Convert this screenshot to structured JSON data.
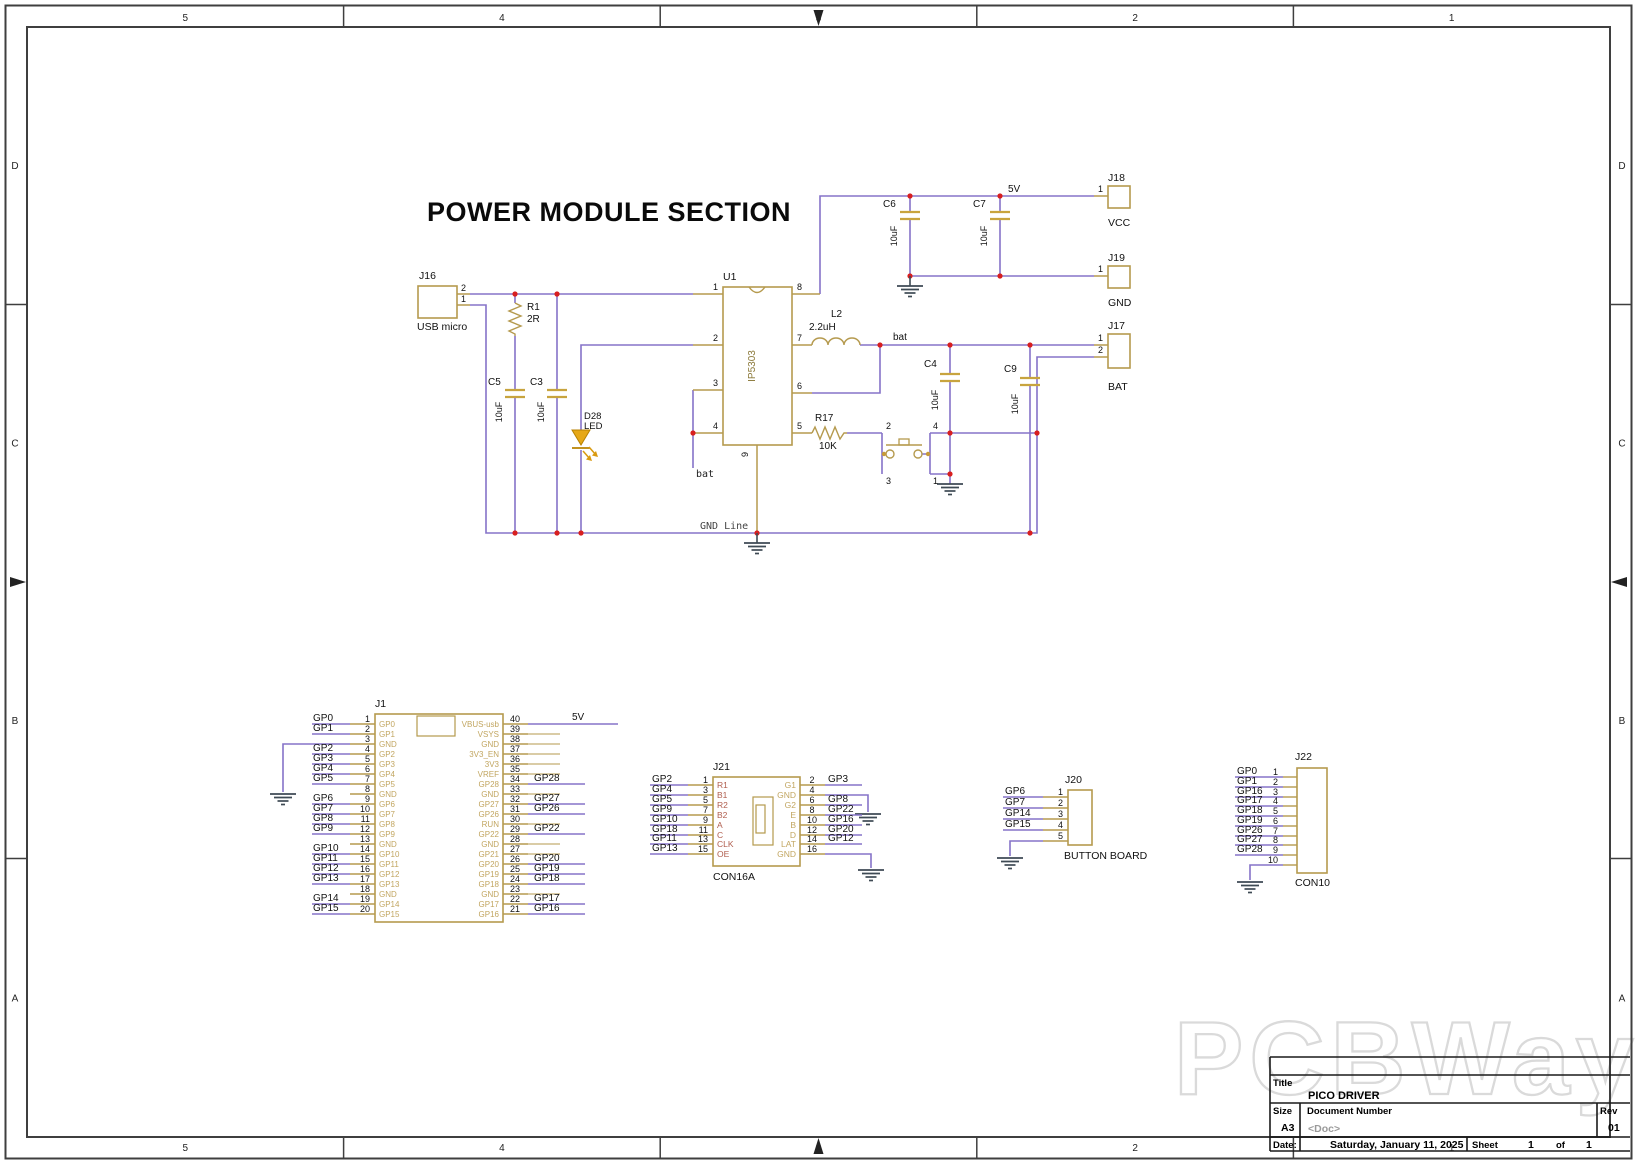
{
  "sheet": {
    "zones_top": [
      "5",
      "4",
      "3",
      "2",
      "1"
    ],
    "zones_side": [
      "D",
      "C",
      "B",
      "A"
    ],
    "watermark": "PCBWay"
  },
  "title_block": {
    "title_label": "Title",
    "title": "PICO DRIVER",
    "size_label": "Size",
    "size": "A3",
    "doc_label": "Document Number",
    "doc": "<Doc>",
    "rev_label": "Rev",
    "rev": "01",
    "date_label": "Date:",
    "date": "Saturday, January 11, 2025",
    "sheet_label": "Sheet",
    "sheet_num": "1",
    "of_label": "of",
    "sheet_total": "1"
  },
  "power": {
    "heading": "POWER MODULE SECTION",
    "j16_ref": "J16",
    "j16_name": "USB micro",
    "j16_p2": "2",
    "j16_p1": "1",
    "r1_ref": "R1",
    "r1_val": "2R",
    "c5_ref": "C5",
    "c5_val": "10uF",
    "c3_ref": "C3",
    "c3_val": "10uF",
    "d28_ref": "D28",
    "d28_val": "LED",
    "u1_ref": "U1",
    "u1_val": "IP5303",
    "u1_p1": "1",
    "u1_p2": "2",
    "u1_p3": "3",
    "u1_p4": "4",
    "u1_p5": "5",
    "u1_p6": "6",
    "u1_p7": "7",
    "u1_p8": "8",
    "u1_p9": "9",
    "l2_ref": "L2",
    "l2_val": "2.2uH",
    "c6_ref": "C6",
    "c6_val": "10uF",
    "c7_ref": "C7",
    "c7_val": "10uF",
    "c4_ref": "C4",
    "c4_val": "10uF",
    "c9_ref": "C9",
    "c9_val": "10uF",
    "r17_ref": "R17",
    "r17_val": "10K",
    "sw_p1": "1",
    "sw_p2": "2",
    "sw_p3": "3",
    "sw_p4": "4",
    "net_5v": "5V",
    "net_bat_rail": "bat",
    "net_bat_stub": "bat",
    "gnd_line": "GND Line",
    "j18_ref": "J18",
    "j18_name": "VCC",
    "j18_p1": "1",
    "j19_ref": "J19",
    "j19_name": "GND",
    "j19_p1": "1",
    "j17_ref": "J17",
    "j17_name": "BAT",
    "j17_p1": "1",
    "j17_p2": "2"
  },
  "j1": {
    "ref": "J1",
    "net_5v": "5V",
    "left": [
      {
        "n": "1",
        "in": "GP0",
        "lbl": "GP0"
      },
      {
        "n": "2",
        "in": "GP1",
        "lbl": "GP1"
      },
      {
        "n": "3",
        "in": "GND",
        "lbl": "",
        "g": true
      },
      {
        "n": "4",
        "in": "GP2",
        "lbl": "GP2"
      },
      {
        "n": "5",
        "in": "GP3",
        "lbl": "GP3"
      },
      {
        "n": "6",
        "in": "GP4",
        "lbl": "GP4"
      },
      {
        "n": "7",
        "in": "GP5",
        "lbl": "GP5"
      },
      {
        "n": "8",
        "in": "GND",
        "lbl": ""
      },
      {
        "n": "9",
        "in": "GP6",
        "lbl": "GP6"
      },
      {
        "n": "10",
        "in": "GP7",
        "lbl": "GP7"
      },
      {
        "n": "11",
        "in": "GP8",
        "lbl": "GP8"
      },
      {
        "n": "12",
        "in": "GP9",
        "lbl": "GP9"
      },
      {
        "n": "13",
        "in": "GND",
        "lbl": ""
      },
      {
        "n": "14",
        "in": "GP10",
        "lbl": "GP10"
      },
      {
        "n": "15",
        "in": "GP11",
        "lbl": "GP11"
      },
      {
        "n": "16",
        "in": "GP12",
        "lbl": "GP12"
      },
      {
        "n": "17",
        "in": "GP13",
        "lbl": "GP13"
      },
      {
        "n": "18",
        "in": "GND",
        "lbl": ""
      },
      {
        "n": "19",
        "in": "GP14",
        "lbl": "GP14"
      },
      {
        "n": "20",
        "in": "GP15",
        "lbl": "GP15"
      }
    ],
    "right": [
      {
        "n": "40",
        "in": "VBUS-usb",
        "lbl": "5V"
      },
      {
        "n": "39",
        "in": "VSYS",
        "lbl": ""
      },
      {
        "n": "38",
        "in": "GND",
        "lbl": ""
      },
      {
        "n": "37",
        "in": "3V3_EN",
        "lbl": ""
      },
      {
        "n": "36",
        "in": "3V3",
        "lbl": ""
      },
      {
        "n": "35",
        "in": "VREF",
        "lbl": ""
      },
      {
        "n": "34",
        "in": "GP28",
        "lbl": "GP28"
      },
      {
        "n": "33",
        "in": "GND",
        "lbl": ""
      },
      {
        "n": "32",
        "in": "GP27",
        "lbl": "GP27"
      },
      {
        "n": "31",
        "in": "GP26",
        "lbl": "GP26"
      },
      {
        "n": "30",
        "in": "RUN",
        "lbl": ""
      },
      {
        "n": "29",
        "in": "GP22",
        "lbl": "GP22"
      },
      {
        "n": "28",
        "in": "GND",
        "lbl": ""
      },
      {
        "n": "27",
        "in": "GP21",
        "lbl": ""
      },
      {
        "n": "26",
        "in": "GP20",
        "lbl": "GP20"
      },
      {
        "n": "25",
        "in": "GP19",
        "lbl": "GP19"
      },
      {
        "n": "24",
        "in": "GP18",
        "lbl": "GP18"
      },
      {
        "n": "23",
        "in": "GND",
        "lbl": ""
      },
      {
        "n": "22",
        "in": "GP17",
        "lbl": "GP17"
      },
      {
        "n": "21",
        "in": "GP16",
        "lbl": "GP16"
      }
    ]
  },
  "j21": {
    "ref": "J21",
    "name": "CON16A",
    "left": [
      {
        "n": "1",
        "in": "R1",
        "lbl": "GP2"
      },
      {
        "n": "3",
        "in": "B1",
        "lbl": "GP4"
      },
      {
        "n": "5",
        "in": "R2",
        "lbl": "GP5"
      },
      {
        "n": "7",
        "in": "B2",
        "lbl": "GP9"
      },
      {
        "n": "9",
        "in": "A",
        "lbl": "GP10"
      },
      {
        "n": "11",
        "in": "C",
        "lbl": "GP18"
      },
      {
        "n": "13",
        "in": "CLK",
        "lbl": "GP11"
      },
      {
        "n": "15",
        "in": "OE",
        "lbl": "GP13"
      }
    ],
    "right": [
      {
        "n": "2",
        "in": "G1",
        "lbl": "GP3"
      },
      {
        "n": "4",
        "in": "GND",
        "lbl": "",
        "g": true
      },
      {
        "n": "6",
        "in": "G2",
        "lbl": "GP8"
      },
      {
        "n": "8",
        "in": "E",
        "lbl": "GP22"
      },
      {
        "n": "10",
        "in": "B",
        "lbl": "GP16"
      },
      {
        "n": "12",
        "in": "D",
        "lbl": "GP20"
      },
      {
        "n": "14",
        "in": "LAT",
        "lbl": "GP12"
      },
      {
        "n": "16",
        "in": "GND",
        "lbl": "",
        "g": true
      }
    ]
  },
  "j20": {
    "ref": "J20",
    "name": "BUTTON BOARD",
    "rows": [
      {
        "n": "1",
        "lbl": "GP6"
      },
      {
        "n": "2",
        "lbl": "GP7"
      },
      {
        "n": "3",
        "lbl": "GP14"
      },
      {
        "n": "4",
        "lbl": "GP15"
      },
      {
        "n": "5",
        "lbl": "",
        "g": true
      }
    ]
  },
  "j22": {
    "ref": "J22",
    "name": "CON10",
    "rows": [
      {
        "n": "1",
        "lbl": "GP0"
      },
      {
        "n": "2",
        "lbl": "GP1"
      },
      {
        "n": "3",
        "lbl": "GP16"
      },
      {
        "n": "4",
        "lbl": "GP17"
      },
      {
        "n": "5",
        "lbl": "GP18"
      },
      {
        "n": "6",
        "lbl": "GP19"
      },
      {
        "n": "7",
        "lbl": "GP26"
      },
      {
        "n": "8",
        "lbl": "GP27"
      },
      {
        "n": "9",
        "lbl": "GP28"
      },
      {
        "n": "10",
        "lbl": "",
        "g": true
      }
    ]
  }
}
